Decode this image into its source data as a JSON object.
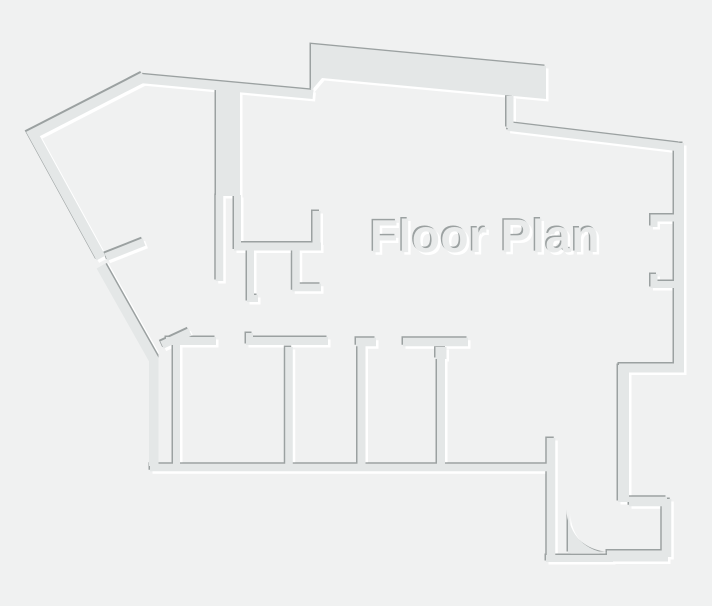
{
  "title": {
    "label": "Floor Plan"
  },
  "colors": {
    "background": "#f0f1f1",
    "wall_fill": "#e4e7e7",
    "edge_dark": "#9ba1a1",
    "edge_light": "#ffffff",
    "text_fill": "#e9ebeb"
  },
  "floor_plan": {
    "canvas": {
      "width": 712,
      "height": 606
    },
    "label": {
      "x": 485,
      "y": 252
    },
    "walls": [
      {
        "name": "outer-topleft-diagonal",
        "kind": "polyline",
        "pts": "144,77 33,134 101,258",
        "w": 10
      },
      {
        "name": "outer-left-diagonal",
        "kind": "polyline",
        "pts": "101,266 154,360 154,466",
        "w": 10,
        "emboss": "flip"
      },
      {
        "name": "outer-top-left",
        "kind": "polyline",
        "pts": "140,78.5 313,94.5",
        "w": 9
      },
      {
        "name": "outer-top-band",
        "kind": "polygon",
        "pts": "311,44 546,66 546,99 322,78 311,91"
      },
      {
        "name": "outer-top-notch",
        "kind": "polyline",
        "pts": "510,96 510,128",
        "w": 7
      },
      {
        "name": "outer-top-right",
        "kind": "polyline",
        "pts": "508,126.5 679,147",
        "w": 8.5
      },
      {
        "name": "outer-right",
        "kind": "polyline",
        "pts": "679,143 679,368",
        "w": 10
      },
      {
        "name": "outer-right-step",
        "kind": "polyline",
        "pts": "619,368 684,368",
        "w": 9
      },
      {
        "name": "outer-right-descender",
        "kind": "polyline",
        "pts": "623.5,365 623.5,502",
        "w": 11
      },
      {
        "name": "entry-top",
        "kind": "polyline",
        "pts": "629,501.5 667,501.5",
        "w": 9.5
      },
      {
        "name": "entry-right",
        "kind": "polyline",
        "pts": "666.5,499 666.5,557",
        "w": 9.5
      },
      {
        "name": "entry-bottom",
        "kind": "polyline",
        "pts": "607,556 668,556",
        "w": 11
      },
      {
        "name": "entry-threshold",
        "kind": "polyline",
        "pts": "546,558.5 613,558.5",
        "w": 7
      },
      {
        "name": "entry-left",
        "kind": "polyline",
        "pts": "551,438 551,560",
        "w": 8.5
      },
      {
        "name": "bottom-wall",
        "kind": "polyline",
        "pts": "150,467.5 552,467.5",
        "w": 7.5
      },
      {
        "name": "rooms-left-inner",
        "kind": "polyline",
        "pts": "176.5,344 176.5,465",
        "w": 7
      },
      {
        "name": "chase",
        "kind": "polygon",
        "pts": "216,85 240,87 240,196 216,196"
      },
      {
        "name": "chase-left",
        "kind": "polyline",
        "pts": "219.5,195 219.5,281",
        "w": 7.5
      },
      {
        "name": "chase-right",
        "kind": "polyline",
        "pts": "237.5,195 237.5,245",
        "w": 7
      },
      {
        "name": "mid-wall-h",
        "kind": "polyline",
        "pts": "234,246.5 321,246.5",
        "w": 8
      },
      {
        "name": "mid-wall-riser",
        "kind": "polyline",
        "pts": "316.5,211 316.5,249",
        "w": 8
      },
      {
        "name": "mid-stub-a",
        "kind": "polyline",
        "pts": "250.5,248 250.5,298.5 258,298.5",
        "w": 7
      },
      {
        "name": "mid-stub-b",
        "kind": "polyline",
        "pts": "296,248 296,287.5 321,287.5",
        "w": 7.5
      },
      {
        "name": "left-door-leaf",
        "kind": "polyline",
        "pts": "106,257 144,242",
        "w": 8
      },
      {
        "name": "corner-stub",
        "kind": "polyline",
        "pts": "162,345 190,332",
        "w": 8
      },
      {
        "name": "rooms-top-a",
        "kind": "polyline",
        "pts": "166,341 216,341",
        "w": 8
      },
      {
        "name": "rooms-top-b",
        "kind": "polyline",
        "pts": "246,341 328,341",
        "w": 8
      },
      {
        "name": "rooms-top-b-tick",
        "kind": "polyline",
        "pts": "246,336 253,336",
        "w": 6
      },
      {
        "name": "room-divider-1",
        "kind": "polyline",
        "pts": "289,347 289,466",
        "w": 7.5
      },
      {
        "name": "rooms-top-c",
        "kind": "polyline",
        "pts": "356,342 376,342",
        "w": 8.5
      },
      {
        "name": "room-divider-2",
        "kind": "polyline",
        "pts": "361.5,343 361.5,466",
        "w": 8
      },
      {
        "name": "rooms-top-d",
        "kind": "polyline",
        "pts": "403,342 468,342",
        "w": 8.5
      },
      {
        "name": "room-divider-3",
        "kind": "polyline",
        "pts": "441,347 441,466",
        "w": 8
      },
      {
        "name": "room-divider-3-cap",
        "kind": "polyline",
        "pts": "441,347 441,359",
        "w": 11
      },
      {
        "name": "right-jamb-upper",
        "kind": "polyline",
        "pts": "654,227 654,218 676,218",
        "w": 7
      },
      {
        "name": "right-jamb-lower",
        "kind": "polyline",
        "pts": "654,274 654,284.5 676,284.5",
        "w": 7
      },
      {
        "name": "entry-door-leaf",
        "kind": "path",
        "d": "M 568,553 L 568,511 A 42 42 0 0 0 610,553 Z"
      }
    ]
  }
}
